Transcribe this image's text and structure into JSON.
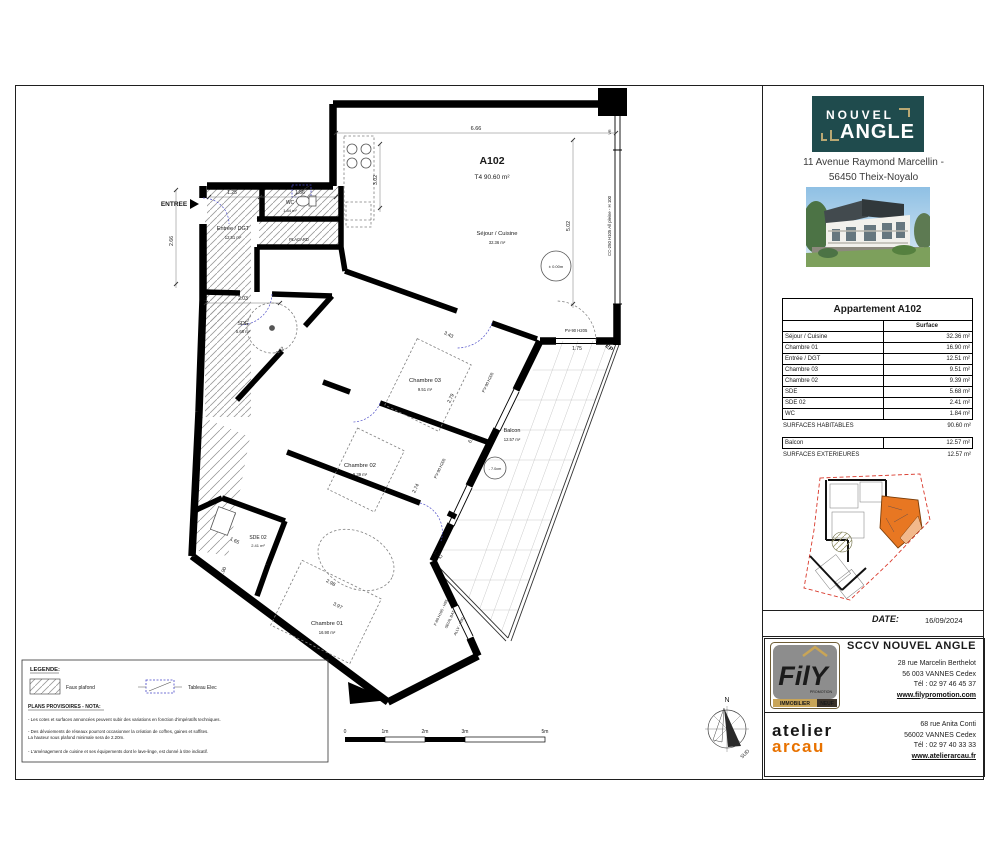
{
  "colors": {
    "teal": "#1F4B4D",
    "gold": "#B9A873",
    "orange": "#E87200",
    "key_red": "#D9392C",
    "key_orange": "#E87722",
    "fily_gray": "#8D8D8D",
    "elec_blue": "#4646C8"
  },
  "plan": {
    "unit": {
      "id": "A102",
      "type_line": "T4  90.60 m²"
    },
    "entry": "ENTREE",
    "rooms": {
      "sejour": {
        "name": "Séjour / Cuisine",
        "area": "32.36 m²"
      },
      "entree": {
        "name": "Entrée / DGT",
        "area": "12.51 m²"
      },
      "wc": {
        "name": "WC",
        "area": "1.84 m²"
      },
      "sde": {
        "name": "SDE",
        "area": "5.68 m²"
      },
      "ch03": {
        "name": "Chambre 03",
        "area": "9.51 m²"
      },
      "ch02": {
        "name": "Chambre 02",
        "area": "9.39 m²"
      },
      "ch01": {
        "name": "Chambre 01",
        "area": "16.90 m²"
      },
      "sde02": {
        "name": "SDE 02",
        "area": "2.41 m²"
      },
      "balcon": {
        "name": "Balcon",
        "area": "12.57 m²"
      }
    },
    "placard": "PLACARD",
    "levels": {
      "sejour": "± 0.00m",
      "balcon": "- 7.0cm"
    },
    "dims": {
      "top": "6.66",
      "right": "5.02",
      "kitchen": "3.02",
      "sde_diag": "3.02",
      "entry_left": "2.66",
      "d125": "1.25",
      "d156": "1.56",
      "d203": "2.03",
      "d343": "3.43",
      "d279": "2.79",
      "d674": "6.74",
      "d274": "2.74",
      "d175": "1.75",
      "d172": "1.72",
      "d298": "2.98",
      "d397": "3.97",
      "d165": "1.65",
      "d90": ".90"
    },
    "windows": {
      "cc250": "CC-250 H105 All pleine - H 100",
      "pv90": "PV-90 H205",
      "f80": "F-80 H105 - H85",
      "seuil": "SEUIL BAT",
      "allv": "ALLV - H90",
      "vr": "VR",
      "ep": "EP"
    },
    "scalebar": {
      "t0": "0",
      "t1": "1m",
      "t2": "2m",
      "t3": "3m",
      "t5": "5m"
    },
    "compass": {
      "n": "N",
      "s": "SUD"
    }
  },
  "legend": {
    "title": "LEGENDE:",
    "faux_plafond": "Faux plafond",
    "tableau_elec": "Tableau Elec",
    "nota_title": "PLANS PROVISOIRES - NOTA:",
    "notes": [
      "- Les cotes et surfaces annoncées peuvent subir des variations en fonction d'impératifs techniques.",
      "- Des dévoiements de réseaux pourront occasionner la création de coffres, gaines et soffites.",
      "La hauteur sous plafond minimale sera de 2.20m.",
      "- L'aménagement de cuisine et ses équipements dont le lave-linge, est donné à titre indicatif."
    ]
  },
  "titleblock": {
    "brand": {
      "line1": "NOUVEL",
      "line2": "ANGLE"
    },
    "address1": "11 Avenue Raymond Marcellin -",
    "address2": "56450 Theix-Noyalo",
    "table": {
      "title": "Appartement A102",
      "col_header": "Surface",
      "rows": [
        {
          "name": "Séjour / Cuisine",
          "area": "32.36 m²"
        },
        {
          "name": "Chambre 01",
          "area": "16.90 m²"
        },
        {
          "name": "Entrée / DGT",
          "area": "12.51 m²"
        },
        {
          "name": "Chambre 03",
          "area": "9.51 m²"
        },
        {
          "name": "Chambre 02",
          "area": "9.39 m²"
        },
        {
          "name": "SDE",
          "area": "5.68 m²"
        },
        {
          "name": "SDE 02",
          "area": "2.41 m²"
        },
        {
          "name": "WC",
          "area": "1.84 m²"
        }
      ],
      "total_label": "SURFACES HABITABLES",
      "total_value": "90.60 m²",
      "balcony_label": "Balcon",
      "balcony_value": "12.57 m²",
      "ext_label": "SURFACES EXTERIEURES",
      "ext_value": "12.57 m²"
    },
    "date_label": "DATE:",
    "date_value": "16/09/2024",
    "fily": {
      "company": "SCCV NOUVEL ANGLE",
      "addr1": "28 rue Marcelin Berthelot",
      "addr2": "56 003 VANNES Cedex",
      "tel": "Tél : 02 97 46 45 37",
      "web": "www.filypromotion.com",
      "logo_text": "FilY",
      "logo_sub": "PROMOTION",
      "banner_left": "IMMOBILIER",
      "banner_right": "NEUF"
    },
    "arcau": {
      "line1": "atelier",
      "line2": "arcau",
      "addr1": "68 rue Anita Conti",
      "addr2": "56002 VANNES Cedex",
      "tel": "Tél : 02 97 40 33 33",
      "web": "www.atelierarcau.fr"
    }
  }
}
